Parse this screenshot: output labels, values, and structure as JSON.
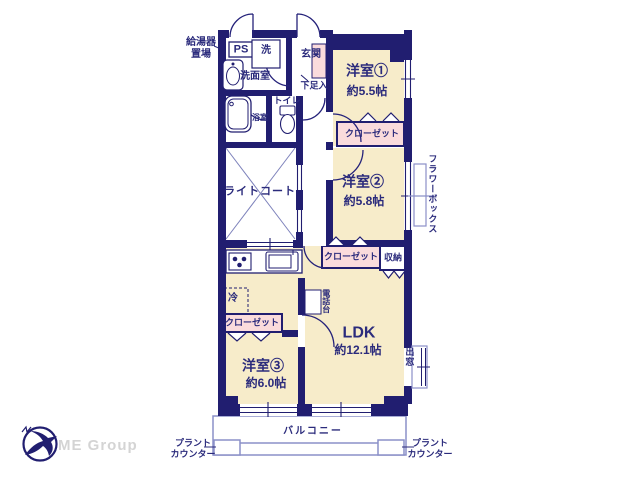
{
  "plan": {
    "labels": {
      "gas_heater": "給湯器\n置場",
      "ps": "PS",
      "laundry": "洗",
      "entrance": "玄関",
      "washroom": "洗面室",
      "shoe_box": "下足入",
      "toilet": "トイレ",
      "bath": "浴室",
      "room1_name": "洋室①",
      "room1_size": "約5.5帖",
      "closet1": "クローゼット",
      "light_court": "ライトコート",
      "room2_name": "洋室②",
      "room2_size": "約5.8帖",
      "flower_box": "フラワーボックス",
      "closet2": "クローゼット",
      "storage": "収納",
      "fridge": "冷",
      "phone_stand": "電話台",
      "closet3": "クローゼット",
      "ldk_name": "LDK",
      "ldk_size": "約12.1帖",
      "room3_name": "洋室③",
      "room3_size": "約6.0帖",
      "bay_window": "出窓",
      "balcony": "バルコニー",
      "plant_counter_left": "プラント\nカウンター",
      "plant_counter_right": "プラント\nカウンター"
    },
    "colors": {
      "wall": "#211e70",
      "room_fill": "#f7ecca",
      "closet_fill": "#fadbdc",
      "light_line": "#8b90c8",
      "text": "#2b2b7c"
    }
  },
  "logo": {
    "text": "ME Group"
  }
}
